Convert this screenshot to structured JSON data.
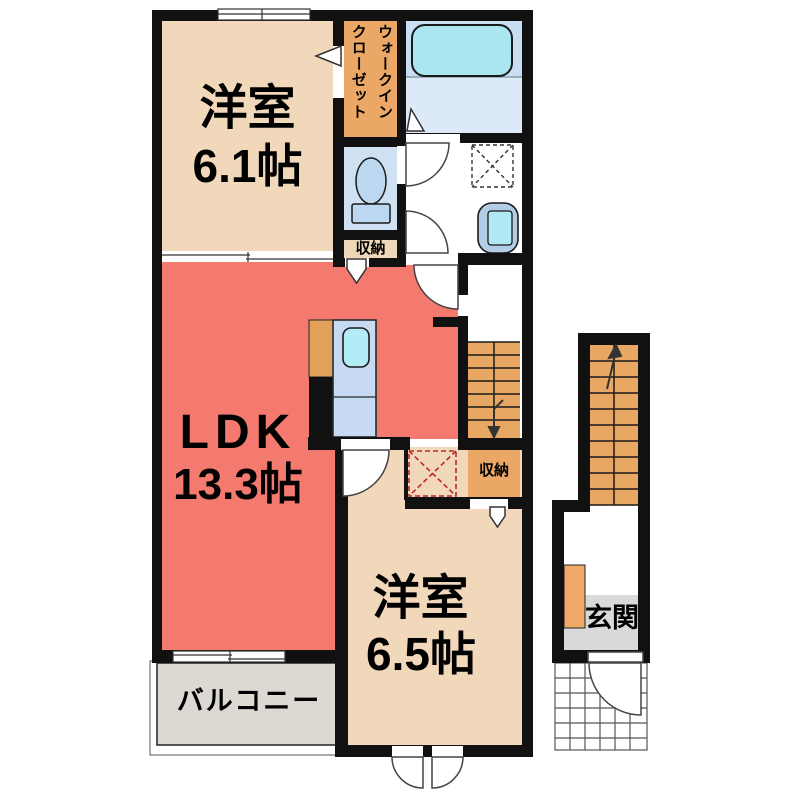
{
  "colors": {
    "wall": "#111111",
    "ldk_red": "#f4796f",
    "room_beige": "#f2d8ba",
    "closet_orange": "#eba766",
    "stairs_orange": "#e8a763",
    "water_blue": "#cfe2f4",
    "fixture_cyan": "#a9e6f0",
    "balcony_gray": "#dcd8d2",
    "entrance_gray": "#d9d9d9",
    "fridge_dashed_red": "#c1272d"
  },
  "rooms": {
    "bedroom1": {
      "name": "洋室",
      "size": "6.1帖"
    },
    "walk_in_closet": {
      "name": "ウォークイン\nクローゼット"
    },
    "storage_hall": {
      "name": "収納"
    },
    "ldk": {
      "name": "LDK",
      "size": "13.3帖"
    },
    "bedroom2": {
      "name": "洋室",
      "size": "6.5帖"
    },
    "storage_stairs": {
      "name": "収納"
    },
    "balcony": {
      "name": "バルコニー"
    },
    "entrance": {
      "name": "玄関"
    }
  }
}
